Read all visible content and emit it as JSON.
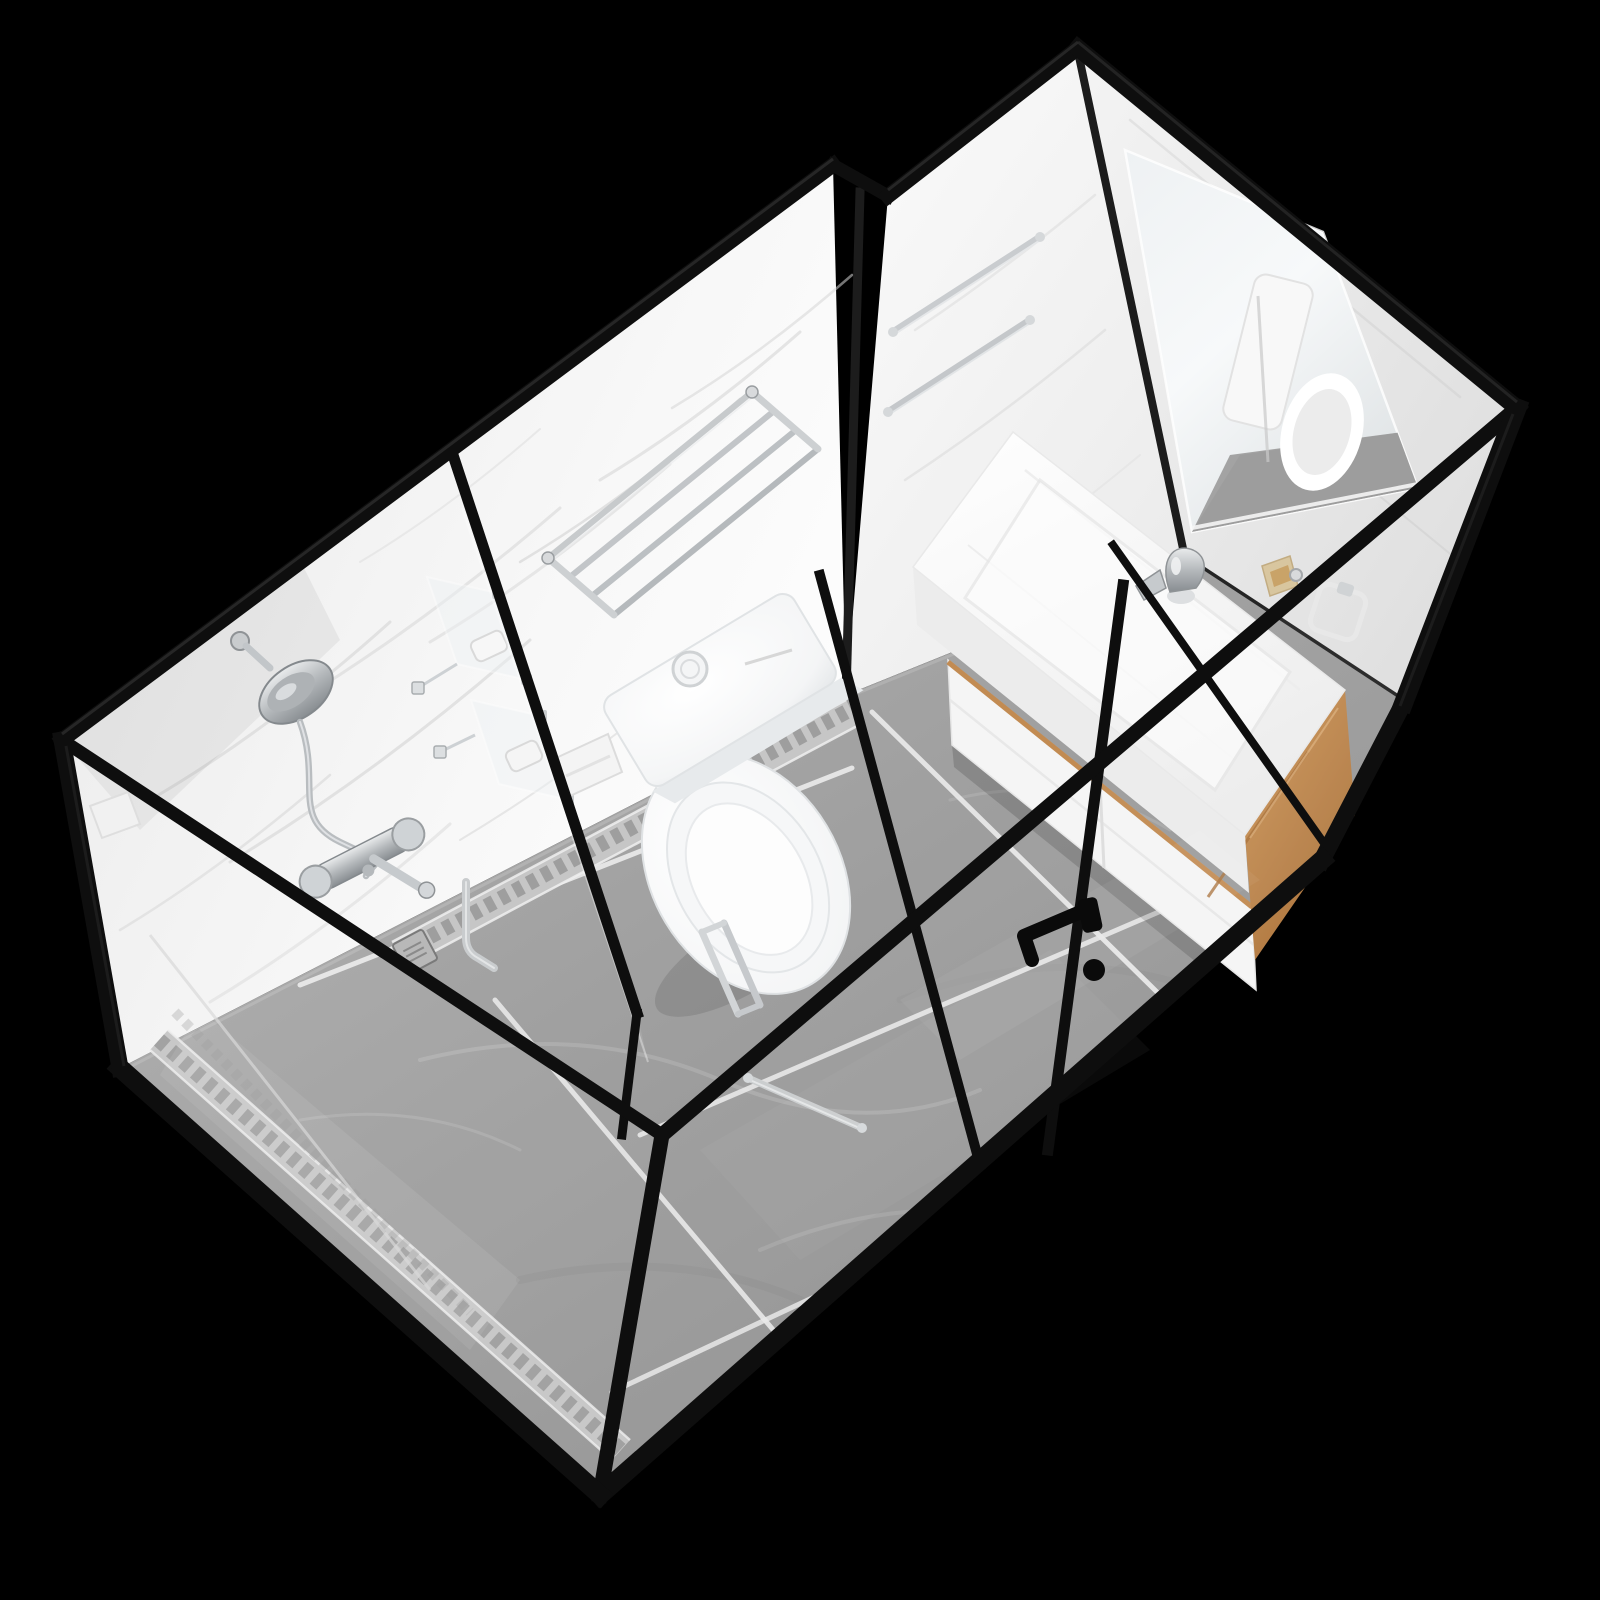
{
  "scene": {
    "description": "3D product render of a prefabricated modular bathroom pod (all-in-one shower room unit) with black aluminium frame and clear glass walls, viewed from above at an isometric angle, on a pure black background",
    "view": "top-down isometric product shot",
    "background": "#000000"
  },
  "palette": {
    "background": "#000000",
    "frame_black": "#0e0e0e",
    "frame_soft": "#1c1c1c",
    "frame_bevel": "#2c2c2c",
    "wall_white": "#f5f5f5",
    "wall_shade": "#e1e1e1",
    "marble_vein": "#d6d6d6",
    "floor_gray": "#9d9d9d",
    "floor_light": "#b6b6b6",
    "grout_white": "#e8e8e8",
    "mosaic_silver": "#c6c6c6",
    "mosaic_dark": "#757575",
    "porcelain_white": "#fbfbfb",
    "porcelain_shade": "#e6e9eb",
    "chrome": "#c3c7ca",
    "chrome_dark": "#8a8f93",
    "wood_oak": "#c28b52",
    "wood_oak_dark": "#a9713a",
    "glass_sheen": "#ffffff",
    "handle_black": "#0a0a0a"
  },
  "objects": {
    "pod": "prefabricated bathroom pod unit",
    "frame": "black aluminium frame profiles",
    "glass_walls": "clear tempered glass wall panels",
    "wall_panels": "white marble-pattern wall panels",
    "floor": "grey marble tile floor with white grout lines",
    "mosaic_border": "patterned mosaic tile border strip",
    "floor_drain": "square stainless floor drain",
    "shower_head": "chrome handheld shower head on wall bracket",
    "shower_hose": "chrome flexible shower hose",
    "shower_mixer": "chrome wall-mounted shower mixer with lever",
    "towel_shelf": "chrome multi-bar towel shelf rack",
    "glass_shelves": "glass corner shelves clipped to partition",
    "soap_dish": "white soap dish",
    "partition": "glass shower partition with black post",
    "toilet": "white one-piece toilet seen from above",
    "flush_button": "round flush button on cistern",
    "paper_holder": "white toilet paper holder",
    "vanity_counter": "white integrated-sink vanity counter",
    "faucet": "chrome basin mixer faucet",
    "vanity_cabinet": "white vanity drawer cabinet",
    "wood_panel": "light oak side panel of vanity",
    "soap_bottle": "amber soap bottle on counter",
    "mirror": "frameless wall mirror reflecting the toilet",
    "towel_bars": "two chrome towel bars on wall",
    "towel_ring": "square towel ring",
    "door_handle_black": "black door lever handle on glass door",
    "door_handle_chrome": "chrome pull handle on inner glass door",
    "grab_bar": "chrome horizontal bar on front glass",
    "drain_pipe": "chrome trap pipe at partition base"
  }
}
